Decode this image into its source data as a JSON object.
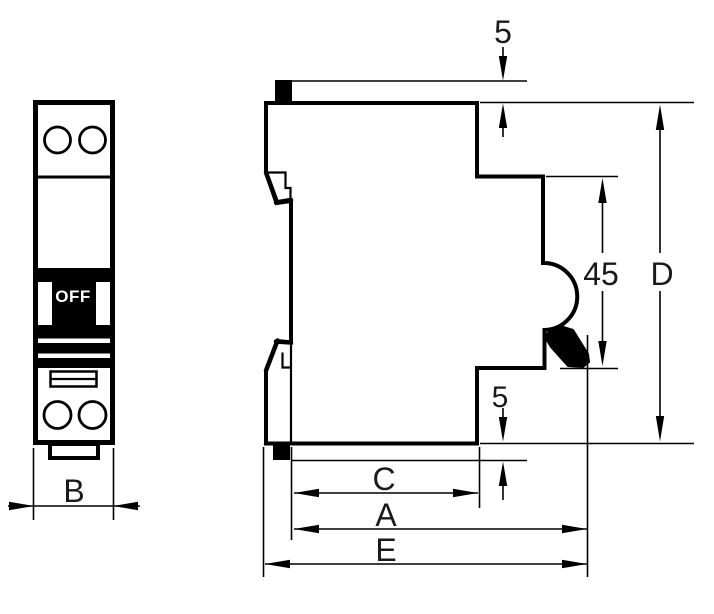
{
  "drawing": {
    "background_color": "#ffffff",
    "line_color": "#000000",
    "label_color": "#1a1a1a",
    "front_view": {
      "name": "front view",
      "switch_label": "OFF",
      "dim_width": "B"
    },
    "side_view": {
      "name": "side view",
      "dim_top_tab": "5",
      "dim_recess": "45",
      "dim_height": "D",
      "dim_foot": "5",
      "dim_c": "C",
      "dim_a": "A",
      "dim_e": "E"
    }
  }
}
